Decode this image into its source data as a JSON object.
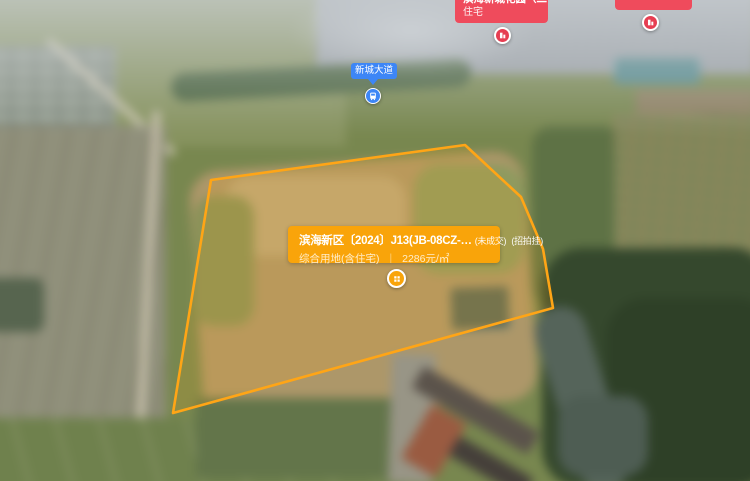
{
  "colors": {
    "polygon_stroke": "#FFA516",
    "card_orange": "#F9A40A",
    "poi_red": "#EF4B5C",
    "road_blue": "#3D86F6"
  },
  "road_marker": {
    "label": "新城大道",
    "icon": "bus-icon"
  },
  "poi_markers": {
    "left": {
      "line1": "滨海新城花园（二手房）",
      "line2": "住宅",
      "icon": "building-icon"
    },
    "right": {
      "line2": "住宅",
      "icon": "building-icon"
    }
  },
  "parcel_card": {
    "title": "滨海新区〔2024〕J13(JB-08CZ-…",
    "badge_status": "(未成交)",
    "badge_method": "(招拍挂)",
    "land_use": "综合用地(含住宅)",
    "divider": "|",
    "unit_price": "2286元/㎡",
    "marker_icon": "building-windows-icon"
  }
}
